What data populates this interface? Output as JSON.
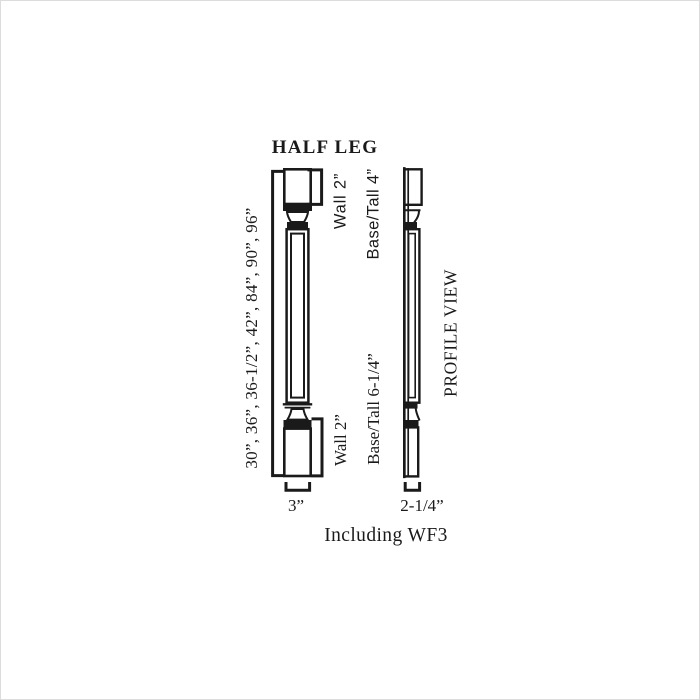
{
  "colors": {
    "ink": "#1a1a1a",
    "background": "#ffffff"
  },
  "title": "HALF LEG",
  "front_view": {
    "heights_label": "30”, 36”, 36-1/2”, 42”, 84”, 90”, 96”",
    "top_block_label": "Wall 2”",
    "top_section_label": "Base/Tall 4”",
    "bottom_block_label": "Wall 2”",
    "bottom_section_label": "Base/Tall 6-1/4”",
    "width_label": "3”"
  },
  "profile_view": {
    "label": "PROFILE VIEW",
    "width_label": "2-1/4”"
  },
  "footnote": "Including WF3"
}
